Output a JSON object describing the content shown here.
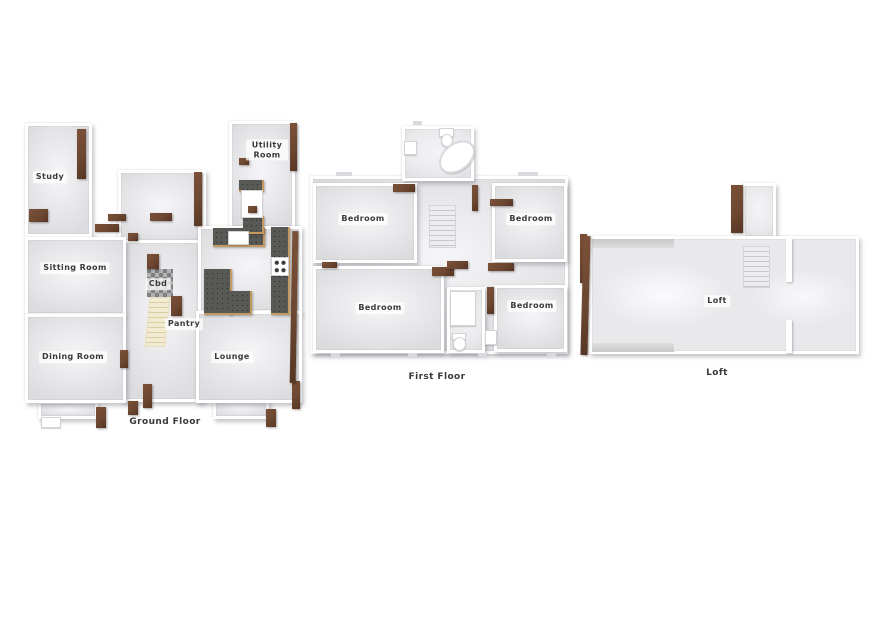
{
  "floors": {
    "ground": {
      "caption": "Ground Floor",
      "rooms": {
        "study": "Study",
        "sitting_room": "Sitting Room",
        "dining_room": "Dining Room",
        "cbd": "Cbd",
        "pantry": "Pantry",
        "lounge": "Lounge",
        "utility_room": "Utility Room"
      }
    },
    "first": {
      "caption": "First Floor",
      "rooms": {
        "bedroom_top_left": "Bedroom",
        "bedroom_top_right": "Bedroom",
        "bedroom_bottom_left": "Bedroom",
        "bedroom_bottom_right": "Bedroom"
      }
    },
    "loft": {
      "caption": "Loft",
      "rooms": {
        "loft": "Loft"
      }
    }
  },
  "fixtures": {
    "ground_staircase": "beige steps",
    "cupboard_floor": "grey checkerboard",
    "kitchen_counters": "dark granite speckle with wood trim",
    "hob": "four-ring cooktop",
    "kitchen_sink": "white inset sink",
    "utility_appliance": "white appliance",
    "bathtub": "white oval tub",
    "toilet": "white toilet",
    "wash_basin": "white basin",
    "shower_tray": "white tray",
    "first_staircase": "grey steps",
    "loft_staircase": "grey steps"
  },
  "colors": {
    "background": "#ffffff",
    "floor_fill": "#e4e4e7",
    "floor_highlight": "#f6f6f8",
    "wall": "#ffffff",
    "wall_shadow": "#c9c9cd",
    "wood_accent": "#6d4731",
    "wood_trim": "#c49a62",
    "counter_dark": "#585855",
    "stair_beige": "#efe5c2",
    "label_text": "#3a3a3a"
  }
}
